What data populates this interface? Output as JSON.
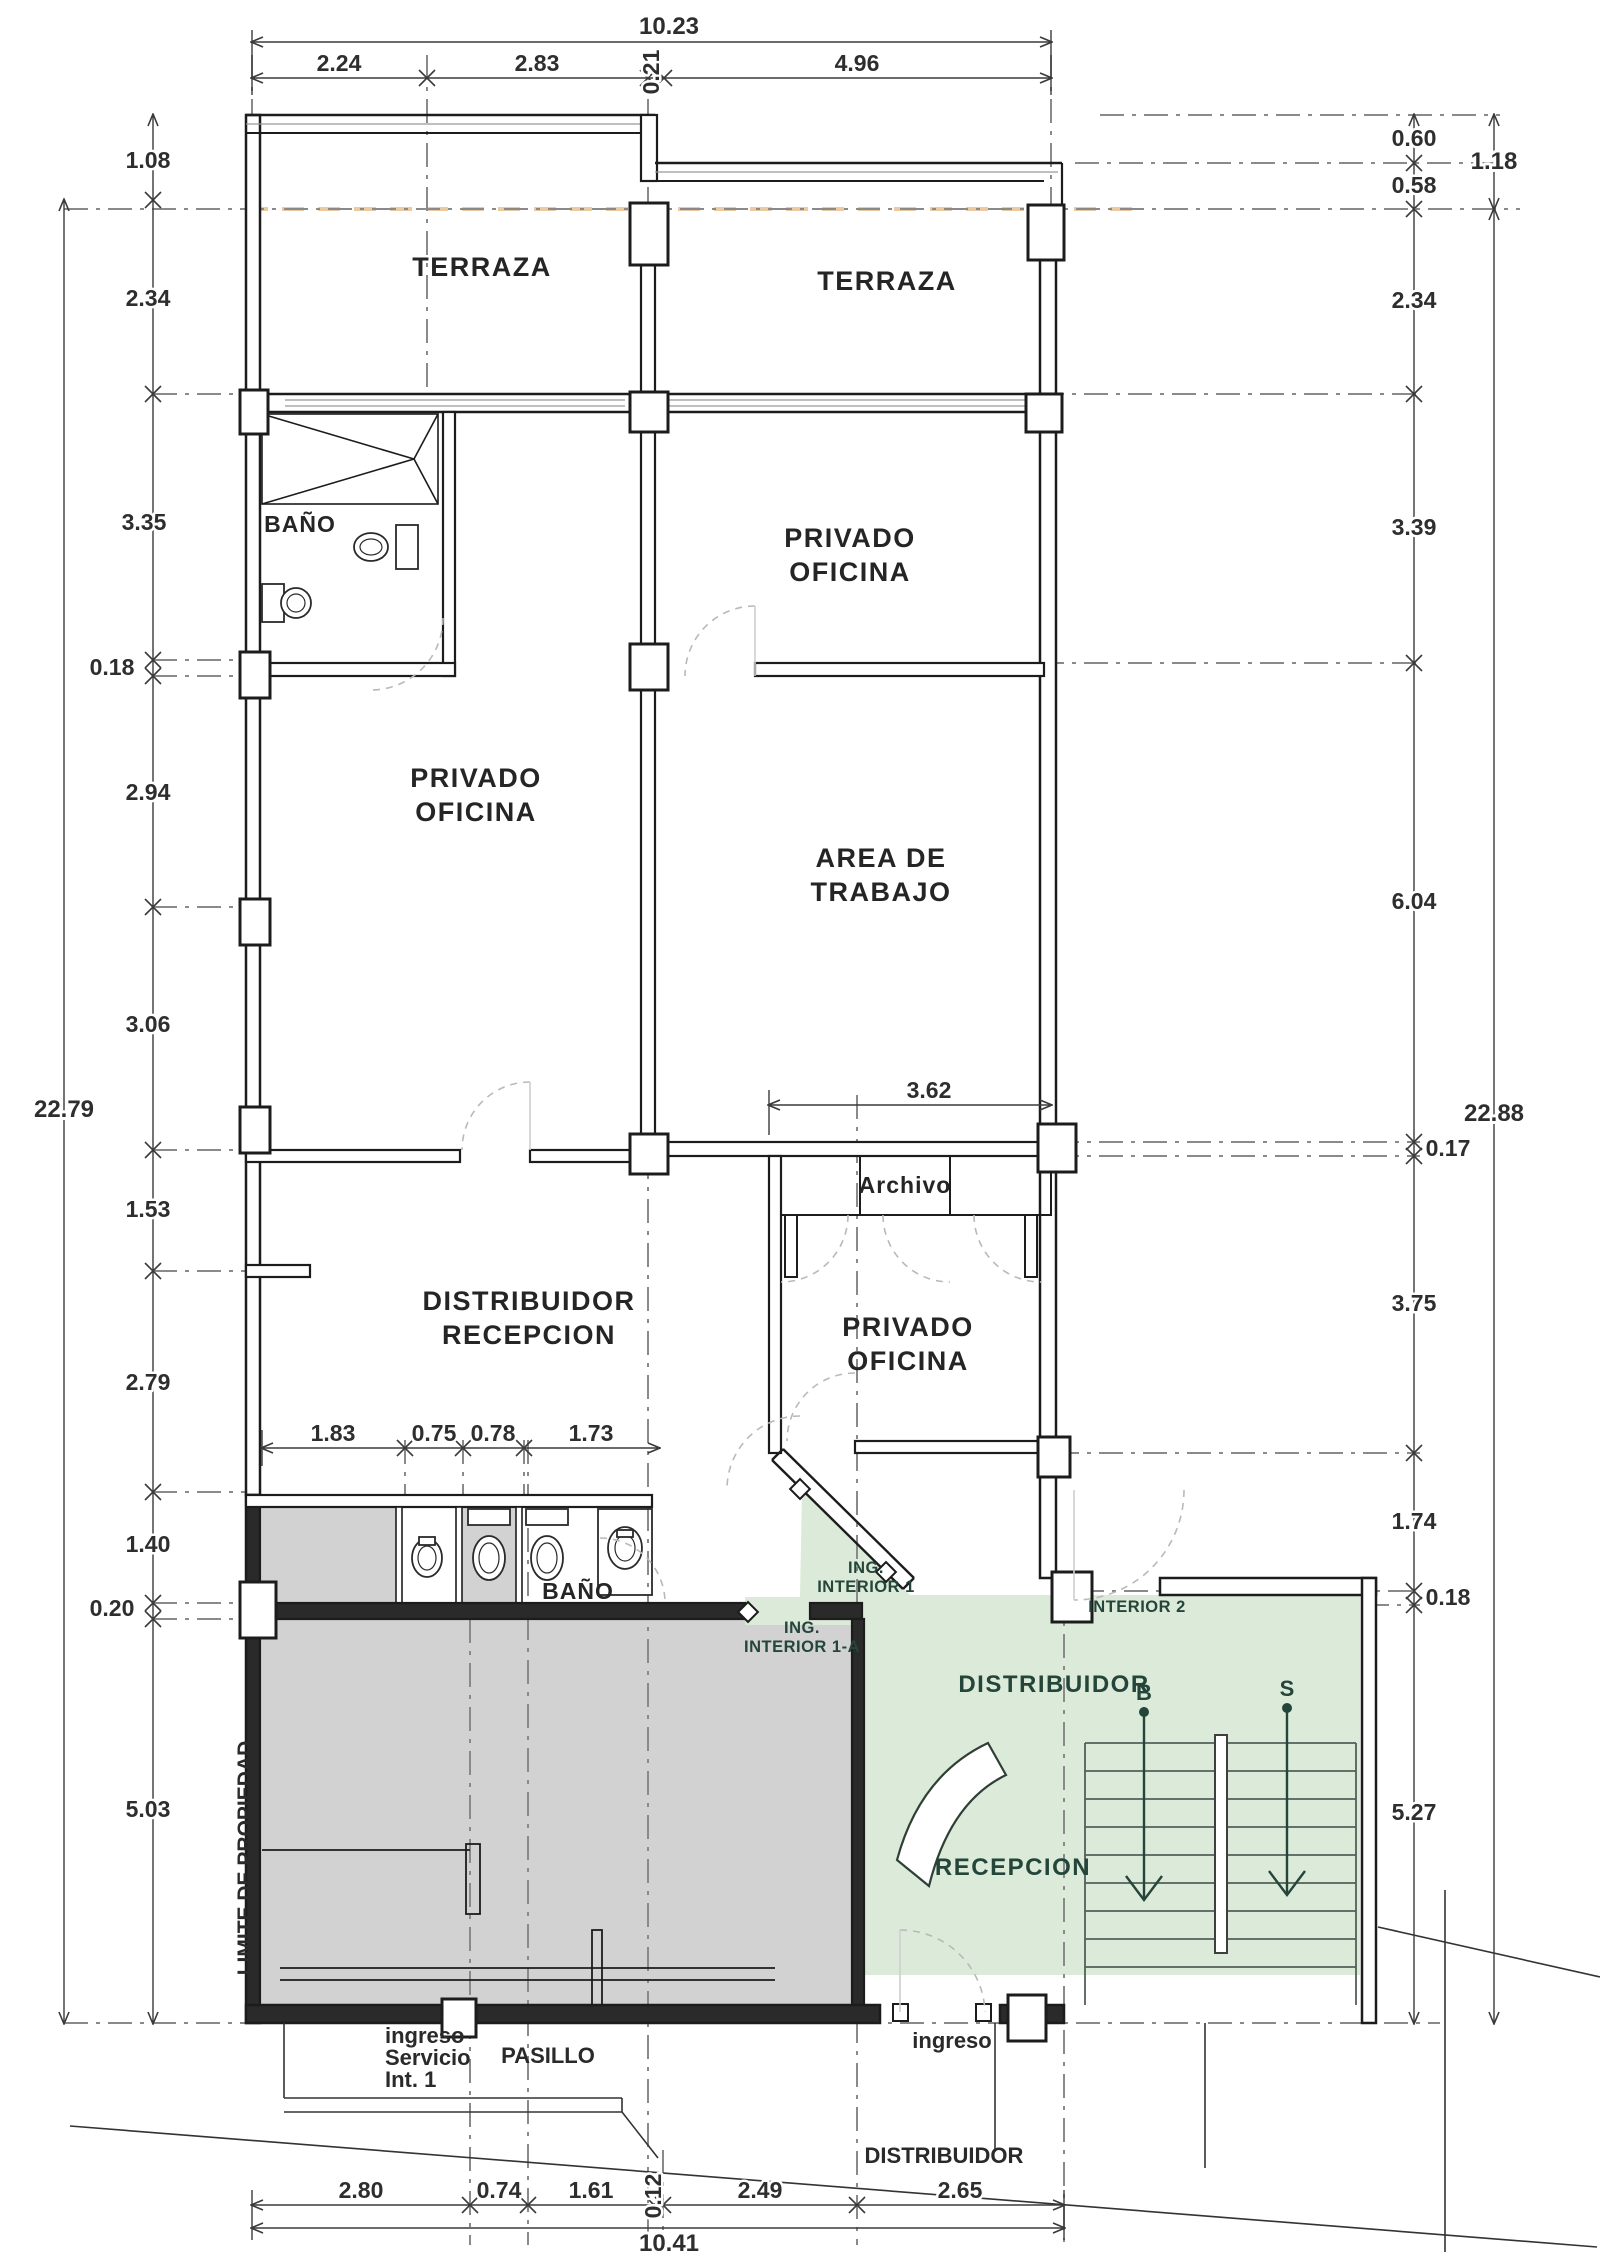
{
  "drawing_type": "architectural floor plan",
  "rooms": {
    "terraza_left": "TERRAZA",
    "terraza_right": "TERRAZA",
    "bano_upper": "BAÑO",
    "privado_oficina_upper_right": [
      "PRIVADO",
      "OFICINA"
    ],
    "privado_oficina_left": [
      "PRIVADO",
      "OFICINA"
    ],
    "area_trabajo": [
      "AREA DE",
      "TRABAJO"
    ],
    "archivo": "Archivo",
    "distribuidor_recepcion": [
      "DISTRIBUIDOR",
      "RECEPCION"
    ],
    "privado_oficina_lower": [
      "PRIVADO",
      "OFICINA"
    ],
    "bano_lower": "BAÑO",
    "distribuidor_green": "DISTRIBUIDOR",
    "recepcion": "RECEPCION",
    "pasillo": "PASILLO",
    "distribuidor_bottom": "DISTRIBUIDOR"
  },
  "annotations": {
    "ing_interior_1": [
      "ING.",
      "INTERIOR 1"
    ],
    "ing_interior_1a": [
      "ING.",
      "INTERIOR 1-A"
    ],
    "interior_2": "INTERIOR 2",
    "limite_propiedad": "LIMITE DE PROPIEDAD",
    "ingreso_servicio": [
      "ingreso",
      "Servicio",
      "Int. 1"
    ],
    "ingreso_main": "ingreso",
    "stair_marker_b": "B",
    "stair_marker_s": "S"
  },
  "dimensions": {
    "top_total": "10.23",
    "top_segments": [
      "2.24",
      "2.83",
      "0.21",
      "4.96"
    ],
    "left_segments": [
      "1.08",
      "2.34",
      "3.35",
      "0.18",
      "2.94",
      "3.06",
      "1.53",
      "2.79",
      "1.40",
      "0.20",
      "5.03"
    ],
    "left_total": "22.79",
    "right_segments": [
      "0.60",
      "0.58",
      "2.34",
      "3.39",
      "6.04",
      "0.17",
      "3.75",
      "1.74",
      "0.18",
      "5.27"
    ],
    "right_upper_total": "1.18",
    "right_total": "22.88",
    "interior_archivo_width": "3.62",
    "bath_segments": [
      "1.83",
      "0.75",
      "0.78",
      "1.73"
    ],
    "bottom_segments": [
      "2.80",
      "0.74",
      "1.61",
      "0.12",
      "2.49",
      "2.65"
    ],
    "bottom_total": "10.41"
  },
  "colors": {
    "wall": "#1c1c1c",
    "gray_zone": "#d2d2d2",
    "green_zone": "#dcead9",
    "green_text": "#24453a",
    "terrace_dashed_line": "#eccaa1",
    "dimension_line": "#3a3a3a"
  }
}
